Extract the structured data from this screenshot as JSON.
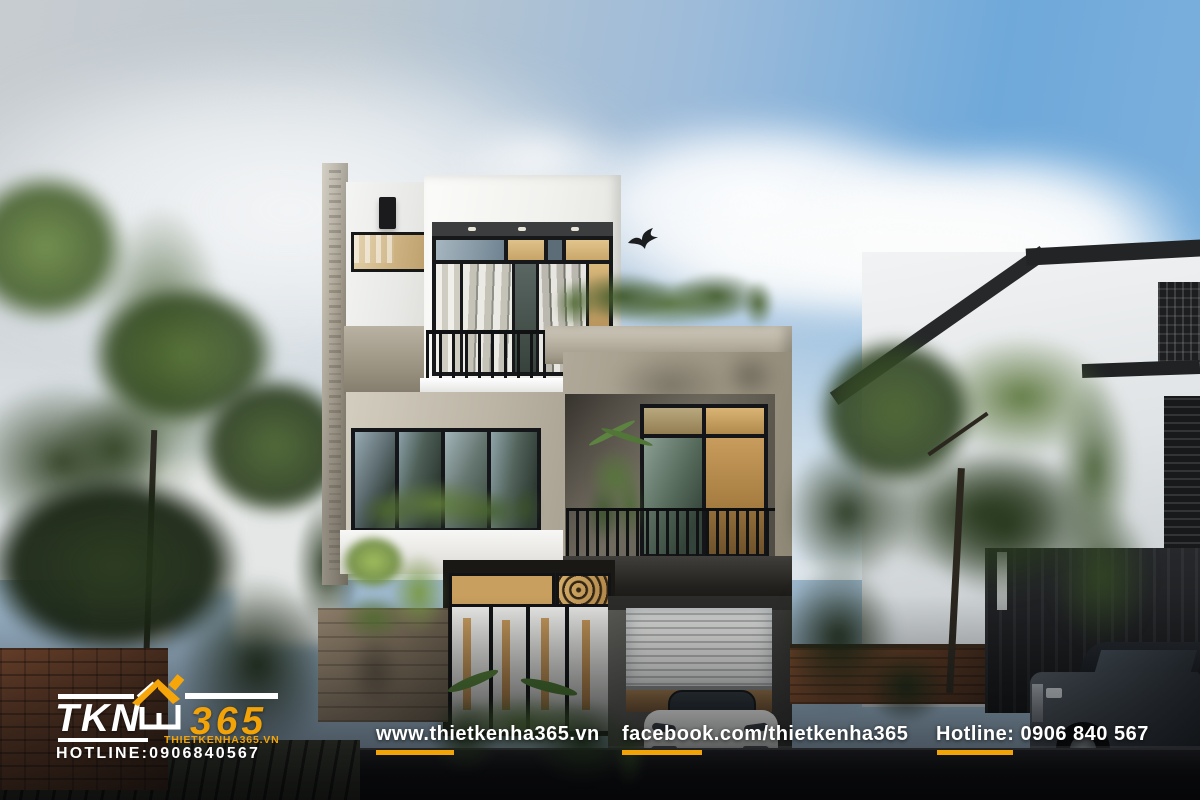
{
  "watermark_logo": {
    "brand_left": "TKN",
    "brand_right": "365",
    "house_icon": "house-roof-icon",
    "website": "THIETKENHA365.VN",
    "hotline": "HOTLINE:0906840567",
    "accent_color": "#F7A60A",
    "text_color": "#FFFFFF"
  },
  "footer_bar": {
    "website": "www.thietkenha365.vn",
    "facebook": "facebook.com/thietkenha365",
    "hotline": "Hotline: 0906 840 567",
    "underline_color": "#F2A307",
    "text_color": "#FFFFFF"
  },
  "scene_colors": {
    "sky_blue": "#6FA9DA",
    "concrete_grey": "#A59D8E",
    "foliage_green": "#3F5A2E",
    "frame_black": "#141518",
    "warm_glass": "#D0AE74"
  }
}
